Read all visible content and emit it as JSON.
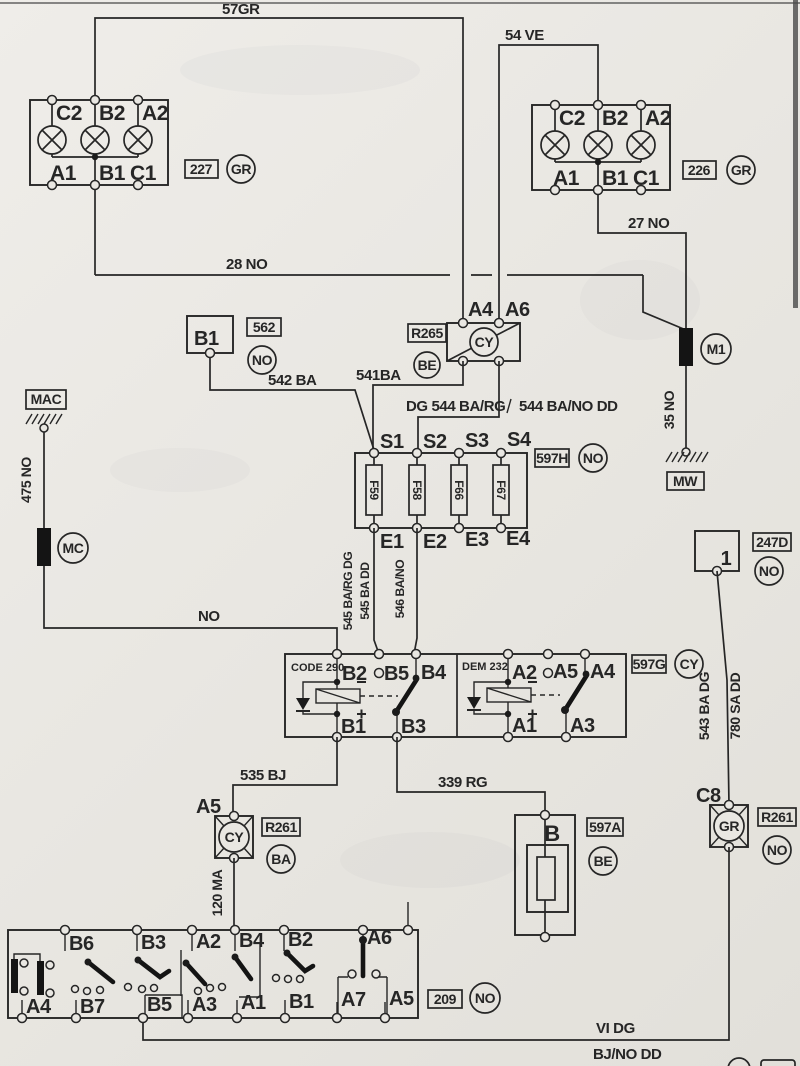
{
  "wires": {
    "w57": "57GR",
    "w54": "54 VE",
    "w28": "28 NO",
    "w27": "27 NO",
    "w35": "35 NO",
    "w475": "475 NO",
    "wno": "NO",
    "w542": "542 BA",
    "w541": "541BA",
    "w544a": "DG 544 BA/RG",
    "w544b": "544 BA/NO DD",
    "w545a": "545 BA/RG DG",
    "w545b": "545 BA DD",
    "w546": "546 BA/NO",
    "w535": "535 BJ",
    "w339": "339 RG",
    "w120": "120 MA",
    "w543": "543 BA  DG",
    "w780": "780 SA  DD",
    "wvi": "VI  DG",
    "wbj": "BJ/NO DD"
  },
  "lampL": {
    "id": "227",
    "code": "GR",
    "t1": "C2",
    "t2": "B2",
    "t3": "A2",
    "b1": "A1",
    "b2": "B1",
    "b3": "C1"
  },
  "lampR": {
    "id": "226",
    "code": "GR",
    "t1": "C2",
    "t2": "B2",
    "t3": "A2",
    "b1": "A1",
    "b2": "B1",
    "b3": "C1"
  },
  "u562": {
    "label": "B1",
    "id": "562",
    "code": "NO"
  },
  "r265": {
    "id": "R265",
    "code": "BE",
    "cy": "CY",
    "a4": "A4",
    "a6": "A6"
  },
  "m1": {
    "label": "M1",
    "mw": "MW"
  },
  "mac": {
    "label": "MAC"
  },
  "mc": {
    "label": "MC"
  },
  "fb": {
    "id": "597H",
    "code": "NO",
    "s1": "S1",
    "s2": "S2",
    "s3": "S3",
    "s4": "S4",
    "e1": "E1",
    "e2": "E2",
    "e3": "E3",
    "e4": "E4",
    "f1": "F59",
    "f2": "F58",
    "f3": "F66",
    "f4": "F67"
  },
  "rly": {
    "id": "597G",
    "code": "CY",
    "ln": "CODE 290",
    "rn": "DEM 232",
    "b2": "B2",
    "b5": "B5",
    "b4": "B4",
    "b1": "B1",
    "b3": "B3",
    "a2": "A2",
    "a5": "A5",
    "a4": "A4",
    "a1": "A1",
    "a3": "A3"
  },
  "c247": {
    "id": "247D",
    "code": "NO",
    "pin": "1"
  },
  "r261a": {
    "id": "R261",
    "code": "BA",
    "cy": "CY",
    "t": "A5"
  },
  "f597a": {
    "id": "597A",
    "code": "BE",
    "label": "B"
  },
  "r261b": {
    "id": "R261",
    "code": "NO",
    "gr": "GR",
    "t": "C8"
  },
  "sw": {
    "id": "209",
    "code": "NO",
    "t1": "B6",
    "t2": "B3",
    "t3": "A2",
    "t4": "B4",
    "t5": "B2",
    "t6": "A6",
    "g1": "A4",
    "g2": "B7",
    "g3": "B5",
    "g4": "A3",
    "g5": "A1",
    "g6": "B1",
    "g7": "A7",
    "g8": "A5"
  }
}
